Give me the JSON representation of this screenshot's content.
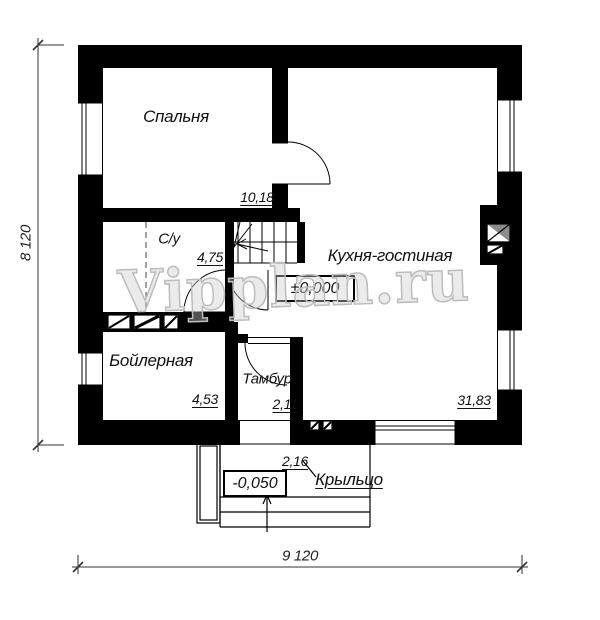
{
  "watermark": "Vipplan.ru",
  "rooms": {
    "bedroom": {
      "name": "Спальня",
      "area": "10,18"
    },
    "bathroom": {
      "name": "С/у",
      "area": "4,75"
    },
    "kitchen_living": {
      "name": "Кухня-гостиная",
      "area": "31,83"
    },
    "boiler": {
      "name": "Бойлерная",
      "area": "4,53"
    },
    "vestibule": {
      "name": "Тамбур",
      "area": "2,11"
    },
    "porch": {
      "name": "Крыльцо",
      "area": "2,16"
    }
  },
  "levels": {
    "ground": "±0,000",
    "porch": "-0,050"
  },
  "dimensions": {
    "horizontal": "9 120",
    "vertical": "8 120"
  },
  "colors": {
    "wall": "#000000",
    "line": "#1a1a1a",
    "watermark": "#bdbdbd",
    "vent_shade": "#8c8c8c",
    "background": "#ffffff"
  }
}
